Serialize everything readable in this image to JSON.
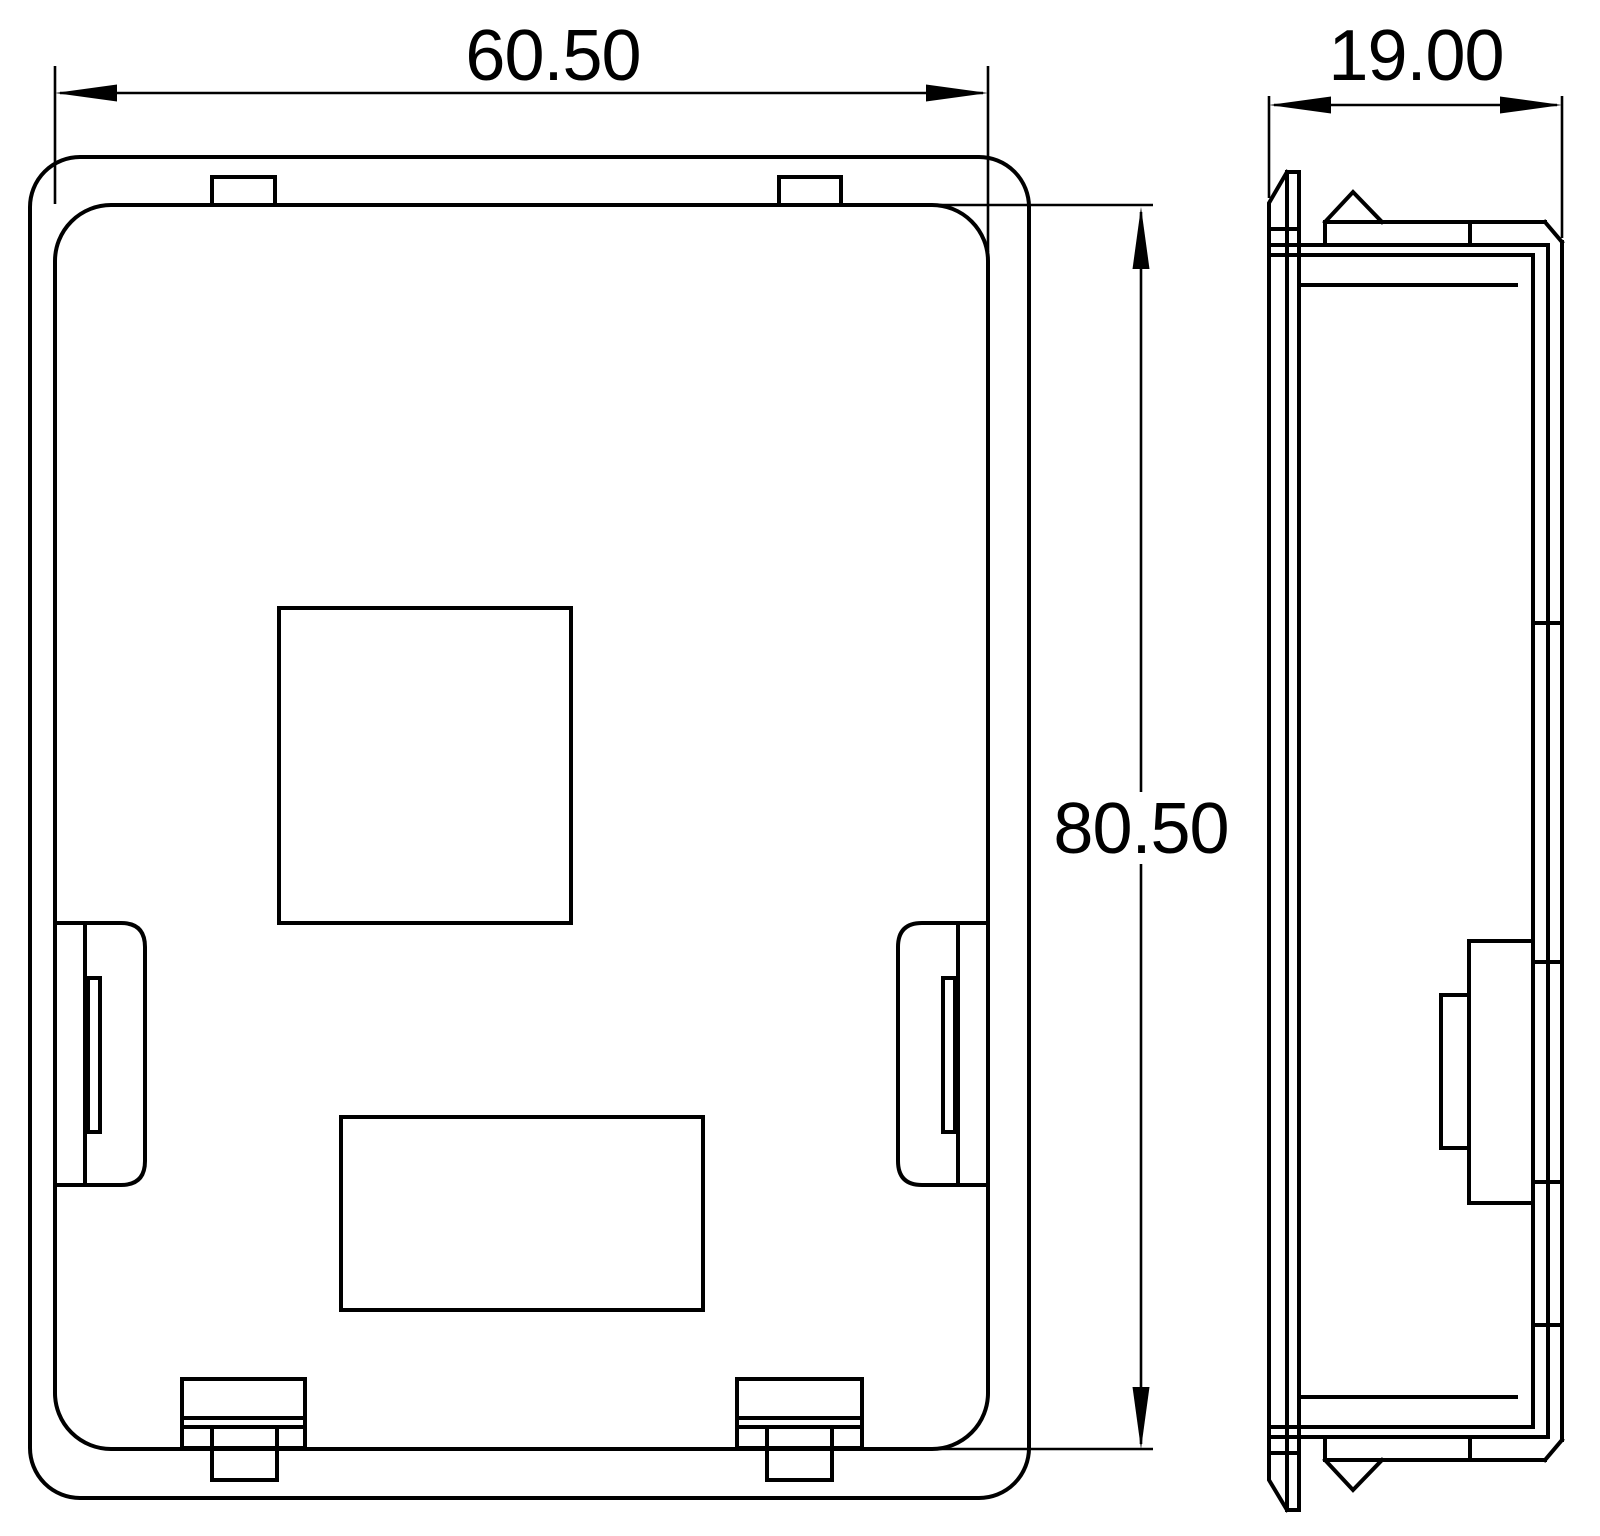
{
  "drawing": {
    "background_color": "#ffffff",
    "line_color": "#000000",
    "dimensions": {
      "front_width": "60.50",
      "front_height": "80.50",
      "side_depth": "19.00"
    }
  }
}
